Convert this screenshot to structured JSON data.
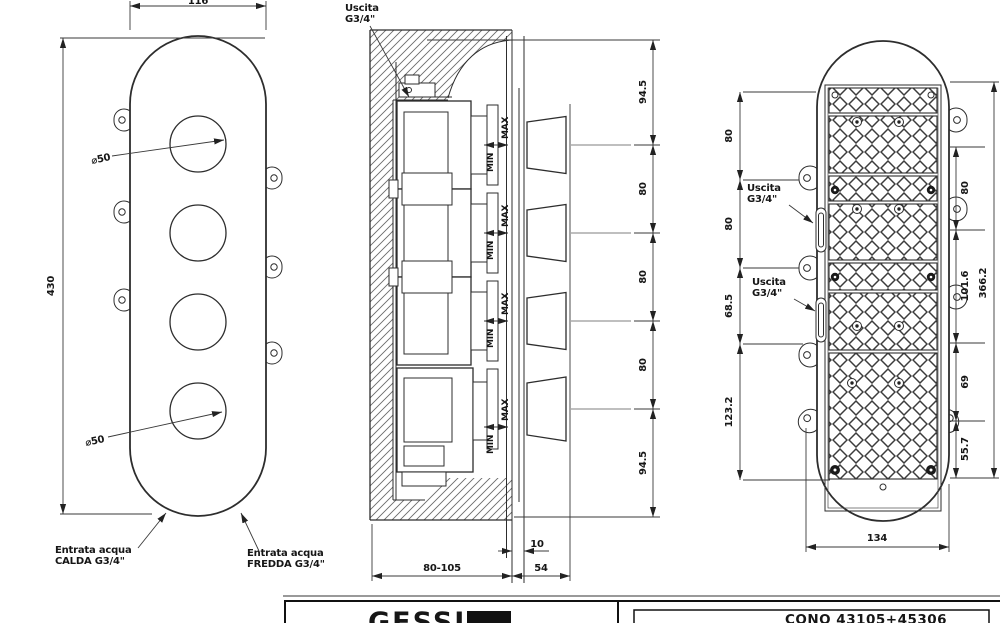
{
  "front_view": {
    "dim_width": "116",
    "dim_height": "430",
    "dia_top": "⌀50",
    "dia_bottom": "⌀50",
    "inlet_hot_1": "Entrata acqua",
    "inlet_hot_2": "CALDA G3/4\"",
    "inlet_cold_1": "Entrata acqua",
    "inlet_cold_2": "FREDDA G3/4\""
  },
  "section_view": {
    "outlet_1": "Uscita",
    "outlet_2": "G3/4\"",
    "max": "MAX",
    "min": "MIN",
    "dims_vertical": [
      "94.5",
      "80",
      "80",
      "80",
      "94.5"
    ],
    "dim_wall_range": "80-105",
    "dim_protrusion": "54",
    "dim_plate_thickness": "10"
  },
  "back_view": {
    "outlet_upper_1": "Uscita",
    "outlet_upper_2": "G3/4\"",
    "outlet_lower_1": "Uscita",
    "outlet_lower_2": "G3/4\"",
    "dims_left": [
      "80",
      "80",
      "68.5",
      "123.2"
    ],
    "dims_right": [
      "80",
      "101.6",
      "69",
      "55.7"
    ],
    "dim_overall": "366.2",
    "dim_width": "134"
  },
  "title_block": {
    "brand": "GESSI",
    "model": "CONO 43105+45306"
  }
}
